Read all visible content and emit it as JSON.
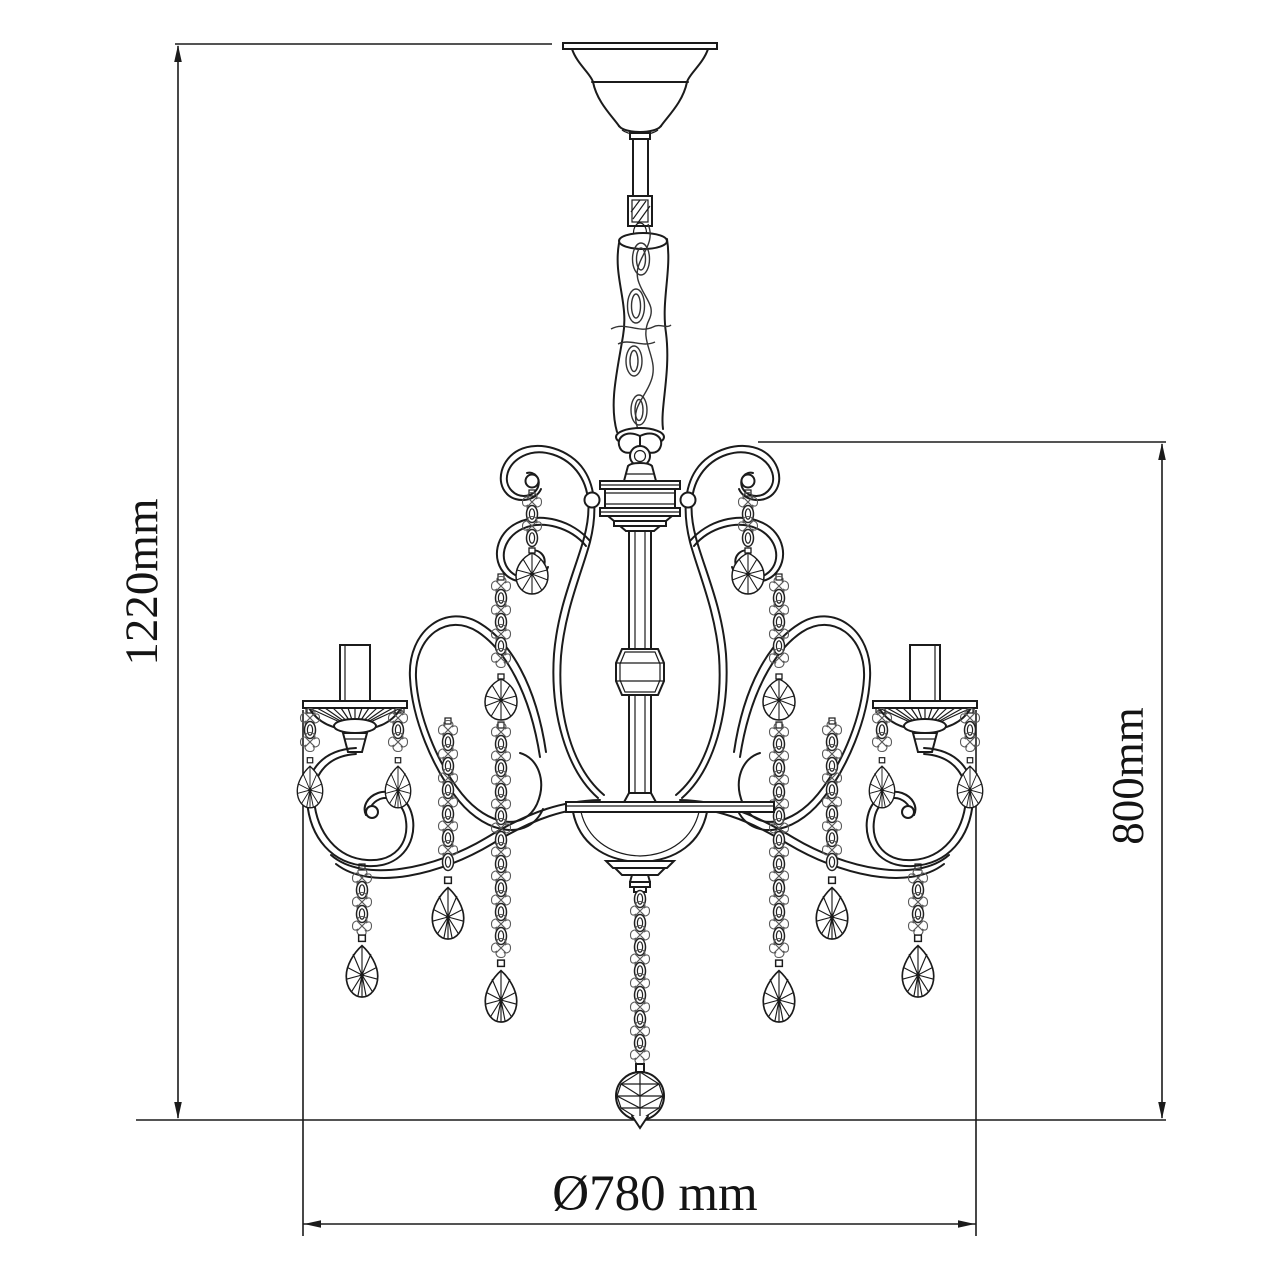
{
  "page": {
    "background": "#ffffff",
    "line_color": "#1b1b1b",
    "drawing_kind": "chandelier dimension drawing"
  },
  "dimensions": {
    "total_height": "1220mm",
    "body_height": "800mm",
    "diameter": "Ø780 mm"
  }
}
